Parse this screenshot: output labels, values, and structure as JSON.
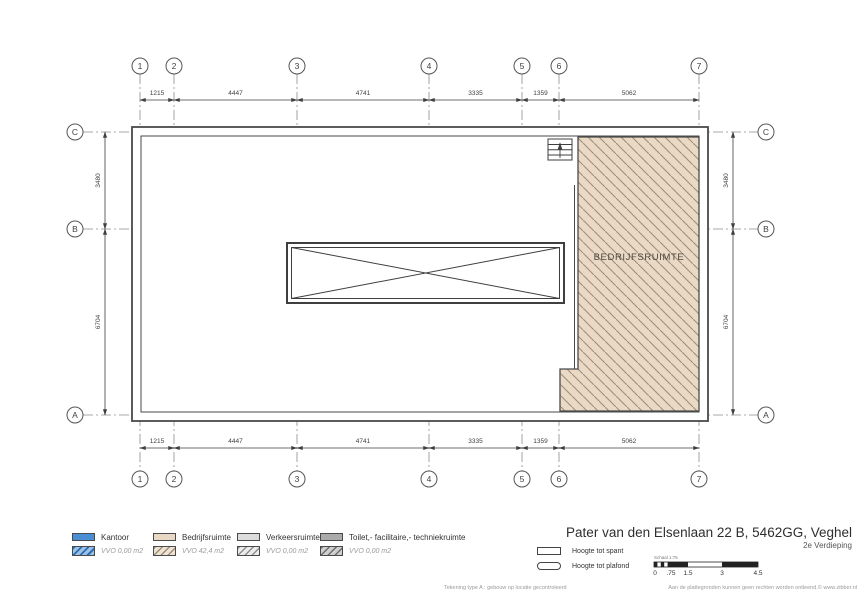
{
  "title": {
    "address": "Pater van den Elsenlaan 22 B, 5462GG, Veghel",
    "floor": "2e Verdieping"
  },
  "plan": {
    "room_label": "BEDRIJFSRUIMTE",
    "grid_cols": [
      "1",
      "2",
      "3",
      "4",
      "5",
      "6",
      "7"
    ],
    "grid_rows": [
      "C",
      "B",
      "A"
    ],
    "dims_h": [
      "1215",
      "4447",
      "4741",
      "3335",
      "1359",
      "5062"
    ],
    "dims_v": [
      "3480",
      "6704"
    ],
    "hatch_fill": "#ead9c5",
    "hatch_line": "#a08e7c",
    "line_color": "#4a4a4a"
  },
  "legend": {
    "items": [
      {
        "label": "Kantoor",
        "vvo": "VVO 0,00 m2",
        "color": "#4a8fd3"
      },
      {
        "label": "Bedrijfsruimte",
        "vvo": "VVO 42,4 m2",
        "color": "#e9d8c4"
      },
      {
        "label": "Verkeersruimte",
        "vvo": "VVO 0,00 m2",
        "color": "#dcdcdc"
      },
      {
        "label": "Toilet,- facilitaire,- techniekruimte",
        "vvo": "VVO 0,00 m2",
        "color": "#ababab"
      }
    ]
  },
  "height_symbols": {
    "spant": "Hoogte tot spant",
    "plafond": "Hoogte tot plafond"
  },
  "scalebar": {
    "label": "Schaal 1:75",
    "ticks": [
      "0",
      ".75",
      "1.5",
      "3",
      "4.5"
    ]
  },
  "footer": {
    "left": "Tekening type A : gebouw op locatie gecontroleerd",
    "right": "Aan de plattegronden kunnen geen rechten worden ontleend.© www.zibber.nl"
  }
}
